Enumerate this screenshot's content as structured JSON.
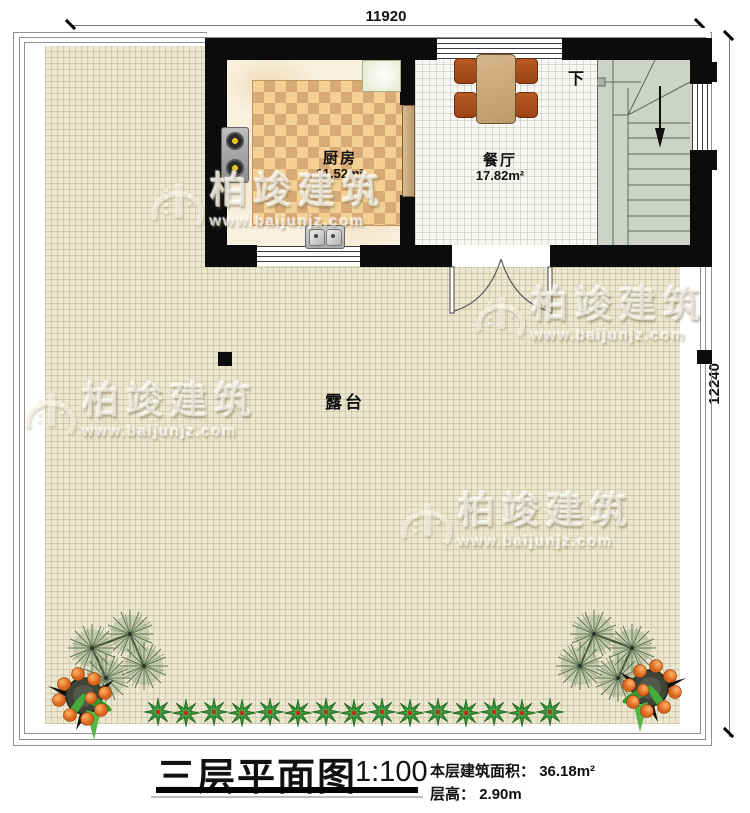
{
  "title_block": {
    "title": "三层平面图",
    "scale": "1:100",
    "area_label": "本层建筑面积：",
    "area_value": "36.18m²",
    "floor_height_label": "层高：",
    "floor_height_value": "2.90m"
  },
  "dimensions": {
    "top_width": "11920",
    "right_height": "12240"
  },
  "rooms": {
    "kitchen": {
      "name": "厨房",
      "area": "11.52m²"
    },
    "dining_room": {
      "name": "餐厅",
      "area": "17.82m²"
    },
    "terrace": {
      "name": "露台"
    },
    "staircase": {
      "direction_label": "下"
    }
  },
  "watermark": {
    "brand": "柏竣建筑",
    "url": "www.baijunjz.com"
  },
  "icons": {
    "stairs_down_arrow": "stairs-down-arrow-icon",
    "double_door": "double-door-swing-icon",
    "dining_table": "dining-table-icon",
    "stove": "stove-burners-icon",
    "sink": "double-sink-icon",
    "fridge": "fridge-counter-icon",
    "pine_plant": "pine-plant-icon",
    "fruit_plant": "potted-fruit-plant-icon",
    "shrub": "shrub-icon"
  },
  "colors": {
    "wall": "#0c0c0c",
    "terrace_floor": "#ece7d1",
    "kitchen_floor": "#f9f0df",
    "rug_dark": "#d8aa76",
    "rug_light": "#f4d094",
    "dining_floor": "#f7f7f3",
    "stairs_floor": "#cdd4c6",
    "table_wood": "#c9a97c",
    "chair_wood": "#a84f1b",
    "fruit_orange": "#e8742a",
    "plant_green": "#2d8a2d"
  }
}
